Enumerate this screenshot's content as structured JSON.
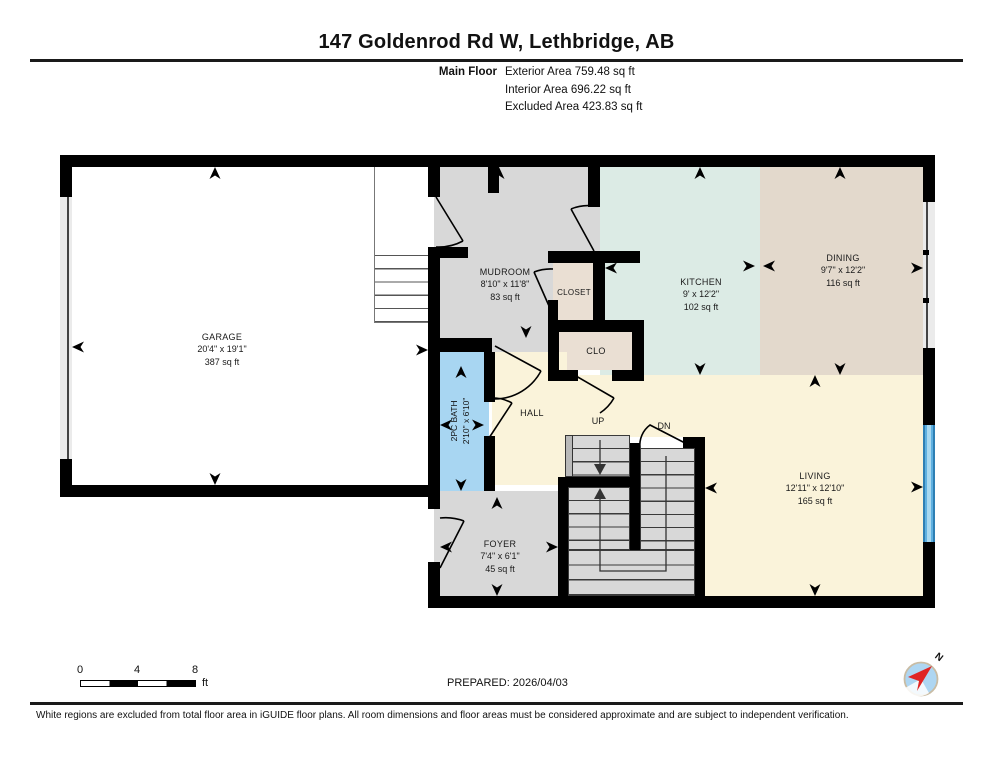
{
  "header": {
    "title": "147 Goldenrod Rd W, Lethbridge, AB",
    "floor_label": "Main Floor",
    "areas": [
      {
        "label": "Exterior Area",
        "value": "759.48 sq ft"
      },
      {
        "label": "Interior Area",
        "value": "696.22 sq ft"
      },
      {
        "label": "Excluded Area",
        "value": "423.83 sq ft"
      }
    ]
  },
  "rooms": {
    "garage": {
      "name": "GARAGE",
      "dims": "20'4\" x 19'1\"",
      "area": "387 sq ft"
    },
    "mudroom": {
      "name": "MUDROOM",
      "dims": "8'10\" x 11'8\"",
      "area": "83 sq ft"
    },
    "closet": {
      "name": "CLOSET"
    },
    "clo": {
      "name": "CLO"
    },
    "kitchen": {
      "name": "KITCHEN",
      "dims": "9' x 12'2\"",
      "area": "102 sq ft"
    },
    "dining": {
      "name": "DINING",
      "dims": "9'7\" x 12'2\"",
      "area": "116 sq ft"
    },
    "hall": {
      "name": "HALL"
    },
    "bath": {
      "name": "2PC BATH",
      "dims": "2'10\" x 6'10\""
    },
    "living": {
      "name": "LIVING",
      "dims": "12'11\" x 12'10\"",
      "area": "165 sq ft"
    },
    "foyer": {
      "name": "FOYER",
      "dims": "7'4\" x 6'1\"",
      "area": "45 sq ft"
    },
    "stairs": {
      "up": "UP",
      "down": "DN"
    }
  },
  "footer": {
    "scale_ticks": [
      "0",
      "4",
      "8"
    ],
    "scale_unit": "ft",
    "prepared": "PREPARED: 2026/04/03",
    "compass_north": "N",
    "disclaimer": "White regions are excluded from total floor area in iGUIDE floor plans. All room dimensions and floor areas must be considered approximate and are subject to independent verification."
  },
  "colors": {
    "wall": "#000000",
    "garage_floor": "#ffffff",
    "mudroom_floor": "#d8d8d8",
    "kitchen_floor": "#dcebe5",
    "dining_floor": "#e3d9cc",
    "closet_floor": "#eadfd3",
    "hall_living_floor": "#faf3da",
    "bath_floor": "#a8d6f2",
    "window_blue": "#4aa0d6",
    "compass_red": "#e02424",
    "compass_blue": "#aed6f2"
  }
}
